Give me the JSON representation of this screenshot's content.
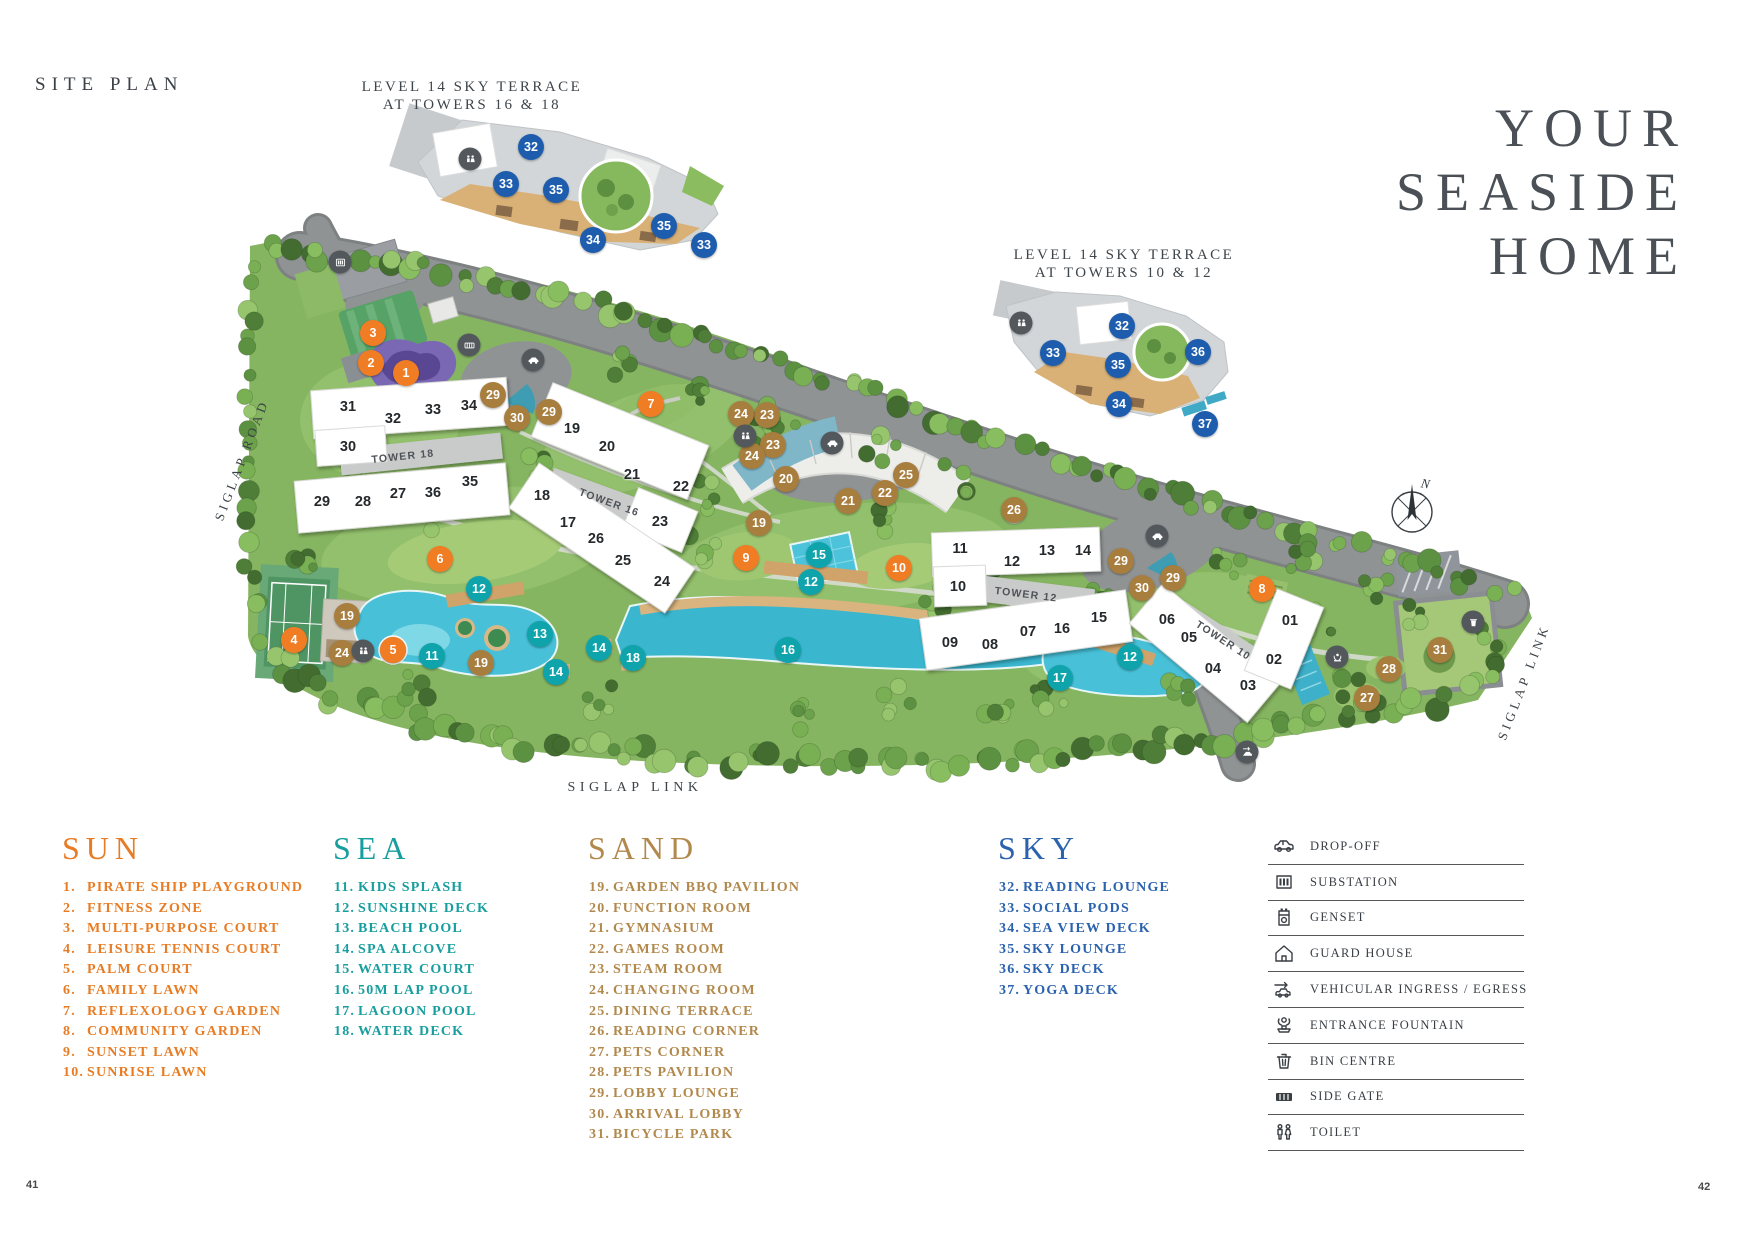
{
  "header": {
    "title": "SITE PLAN"
  },
  "hero": {
    "lines": [
      "YOUR",
      "SEASIDE",
      "HOME"
    ]
  },
  "insets": [
    {
      "line1": "LEVEL 14 SKY TERRACE",
      "line2": "AT TOWERS 16 & 18"
    },
    {
      "line1": "LEVEL 14 SKY TERRACE",
      "line2": "AT TOWERS 10 & 12"
    }
  ],
  "map": {
    "road_labels": {
      "left": "SIGLAP ROAD",
      "bottom": "SIGLAP LINK",
      "right": "SIGLAP LINK"
    },
    "compass": "N",
    "towers": [
      [
        "TOWER 18",
        403,
        457,
        -6
      ],
      [
        "TOWER 16",
        609,
        503,
        20
      ],
      [
        "TOWER 12",
        1026,
        595,
        7
      ],
      [
        "TOWER 10",
        1223,
        641,
        33
      ]
    ],
    "units": [
      [
        "31",
        348,
        407
      ],
      [
        "32",
        393,
        419
      ],
      [
        "33",
        433,
        410
      ],
      [
        "34",
        469,
        406
      ],
      [
        "30",
        348,
        447
      ],
      [
        "29",
        322,
        502
      ],
      [
        "28",
        363,
        502
      ],
      [
        "27",
        398,
        494
      ],
      [
        "36",
        433,
        493
      ],
      [
        "35",
        470,
        482
      ],
      [
        "19",
        572,
        429
      ],
      [
        "20",
        607,
        447
      ],
      [
        "21",
        632,
        475
      ],
      [
        "22",
        681,
        487
      ],
      [
        "23",
        660,
        522
      ],
      [
        "18",
        542,
        496
      ],
      [
        "17",
        568,
        523
      ],
      [
        "26",
        596,
        539
      ],
      [
        "25",
        623,
        561
      ],
      [
        "24",
        662,
        582
      ],
      [
        "11",
        960,
        549
      ],
      [
        "12",
        1012,
        562
      ],
      [
        "13",
        1047,
        551
      ],
      [
        "14",
        1083,
        551
      ],
      [
        "10",
        958,
        587
      ],
      [
        "09",
        950,
        643
      ],
      [
        "08",
        990,
        645
      ],
      [
        "07",
        1028,
        632
      ],
      [
        "16",
        1062,
        629
      ],
      [
        "15",
        1099,
        618
      ],
      [
        "06",
        1167,
        620
      ],
      [
        "05",
        1189,
        638
      ],
      [
        "04",
        1213,
        669
      ],
      [
        "03",
        1248,
        686
      ],
      [
        "02",
        1274,
        660
      ],
      [
        "01",
        1290,
        621
      ]
    ],
    "markers": [
      [
        1,
        406,
        373
      ],
      [
        2,
        371,
        363
      ],
      [
        3,
        373,
        333
      ],
      [
        4,
        294,
        640
      ],
      [
        5,
        393,
        650
      ],
      [
        6,
        440,
        559
      ],
      [
        7,
        651,
        404
      ],
      [
        8,
        1262,
        589
      ],
      [
        9,
        746,
        558
      ],
      [
        10,
        899,
        568
      ],
      [
        11,
        432,
        656
      ],
      [
        12,
        479,
        589
      ],
      [
        12,
        811,
        582
      ],
      [
        12,
        1130,
        657
      ],
      [
        13,
        540,
        634
      ],
      [
        14,
        599,
        648
      ],
      [
        14,
        556,
        672
      ],
      [
        15,
        819,
        555
      ],
      [
        16,
        788,
        650
      ],
      [
        17,
        1060,
        678
      ],
      [
        18,
        633,
        658
      ],
      [
        19,
        347,
        616
      ],
      [
        19,
        481,
        663
      ],
      [
        19,
        759,
        523
      ],
      [
        20,
        786,
        479
      ],
      [
        21,
        848,
        501
      ],
      [
        22,
        885,
        493
      ],
      [
        23,
        767,
        415
      ],
      [
        23,
        773,
        445
      ],
      [
        24,
        741,
        414
      ],
      [
        24,
        752,
        456
      ],
      [
        24,
        342,
        653
      ],
      [
        25,
        906,
        475
      ],
      [
        26,
        1014,
        510
      ],
      [
        27,
        1367,
        698
      ],
      [
        28,
        1389,
        669
      ],
      [
        29,
        493,
        395
      ],
      [
        29,
        549,
        412
      ],
      [
        29,
        1121,
        561
      ],
      [
        29,
        1173,
        578
      ],
      [
        30,
        517,
        418
      ],
      [
        30,
        1142,
        588
      ],
      [
        31,
        1440,
        650
      ],
      [
        32,
        531,
        147
      ],
      [
        33,
        506,
        184
      ],
      [
        35,
        556,
        190
      ],
      [
        34,
        593,
        240
      ],
      [
        35,
        664,
        226
      ],
      [
        33,
        704,
        245
      ],
      [
        32,
        1122,
        326
      ],
      [
        33,
        1053,
        353
      ],
      [
        35,
        1118,
        365
      ],
      [
        36,
        1198,
        352
      ],
      [
        34,
        1119,
        404
      ],
      [
        37,
        1205,
        424
      ]
    ],
    "icons": [
      [
        "substation",
        340,
        262
      ],
      [
        "side-gate",
        469,
        345
      ],
      [
        "drop-off",
        533,
        360
      ],
      [
        "toilet",
        745,
        436
      ],
      [
        "drop-off",
        832,
        443
      ],
      [
        "drop-off",
        1157,
        536
      ],
      [
        "toilet",
        363,
        651
      ],
      [
        "entrance-fountain",
        1337,
        657
      ],
      [
        "bin-centre",
        1473,
        622
      ],
      [
        "vehicular",
        1247,
        752
      ],
      [
        "toilet",
        470,
        159
      ],
      [
        "toilet",
        1021,
        323
      ]
    ]
  },
  "categories": {
    "sun": "#F07C23",
    "sea": "#0FA3AB",
    "sand": "#A87E3F",
    "sky": "#1E5DAD"
  },
  "legend": {
    "columns": [
      {
        "title": "SUN",
        "color": "#E77C25",
        "items": [
          [
            "1",
            "PIRATE SHIP PLAYGROUND"
          ],
          [
            "2",
            "FITNESS ZONE"
          ],
          [
            "3",
            "MULTI-PURPOSE COURT"
          ],
          [
            "4",
            "LEISURE TENNIS COURT"
          ],
          [
            "5",
            "PALM COURT"
          ],
          [
            "6",
            "FAMILY LAWN"
          ],
          [
            "7",
            "REFLEXOLOGY GARDEN"
          ],
          [
            "8",
            "COMMUNITY GARDEN"
          ],
          [
            "9",
            "SUNSET LAWN"
          ],
          [
            "10",
            "SUNRISE LAWN"
          ]
        ]
      },
      {
        "title": "SEA",
        "color": "#189E9E",
        "items": [
          [
            "11",
            "KIDS SPLASH"
          ],
          [
            "12",
            "SUNSHINE DECK"
          ],
          [
            "13",
            "BEACH POOL"
          ],
          [
            "14",
            "SPA ALCOVE"
          ],
          [
            "15",
            "WATER COURT"
          ],
          [
            "16",
            "50M LAP POOL"
          ],
          [
            "17",
            "LAGOON POOL"
          ],
          [
            "18",
            "WATER DECK"
          ]
        ]
      },
      {
        "title": "SAND",
        "color": "#B2894D",
        "items": [
          [
            "19",
            "GARDEN BBQ PAVILION"
          ],
          [
            "20",
            "FUNCTION ROOM"
          ],
          [
            "21",
            "GYMNASIUM"
          ],
          [
            "22",
            "GAMES ROOM"
          ],
          [
            "23",
            "STEAM ROOM"
          ],
          [
            "24",
            "CHANGING ROOM"
          ],
          [
            "25",
            "DINING TERRACE"
          ],
          [
            "26",
            "READING CORNER"
          ],
          [
            "27",
            "PETS CORNER"
          ],
          [
            "28",
            "PETS PAVILION"
          ],
          [
            "29",
            "LOBBY LOUNGE"
          ],
          [
            "30",
            "ARRIVAL LOBBY"
          ],
          [
            "31",
            "BICYCLE PARK"
          ]
        ]
      },
      {
        "title": "SKY",
        "color": "#2B62AE",
        "items": [
          [
            "32",
            "READING LOUNGE"
          ],
          [
            "33",
            "SOCIAL PODS"
          ],
          [
            "34",
            "SEA VIEW DECK"
          ],
          [
            "35",
            "SKY LOUNGE"
          ],
          [
            "36",
            "SKY DECK"
          ],
          [
            "37",
            "YOGA DECK"
          ]
        ]
      }
    ]
  },
  "iconLegend": {
    "rows": [
      {
        "icon": "drop-off",
        "label": "DROP-OFF"
      },
      {
        "icon": "substation",
        "label": "SUBSTATION"
      },
      {
        "icon": "genset",
        "label": "GENSET"
      },
      {
        "icon": "guard-house",
        "label": "GUARD HOUSE"
      },
      {
        "icon": "vehicular",
        "label": "VEHICULAR INGRESS / EGRESS"
      },
      {
        "icon": "entrance-fountain",
        "label": "ENTRANCE FOUNTAIN"
      },
      {
        "icon": "bin-centre",
        "label": "BIN CENTRE"
      },
      {
        "icon": "side-gate",
        "label": "SIDE GATE"
      },
      {
        "icon": "toilet",
        "label": "TOILET"
      }
    ]
  },
  "pages": {
    "left": "41",
    "right": "42"
  }
}
